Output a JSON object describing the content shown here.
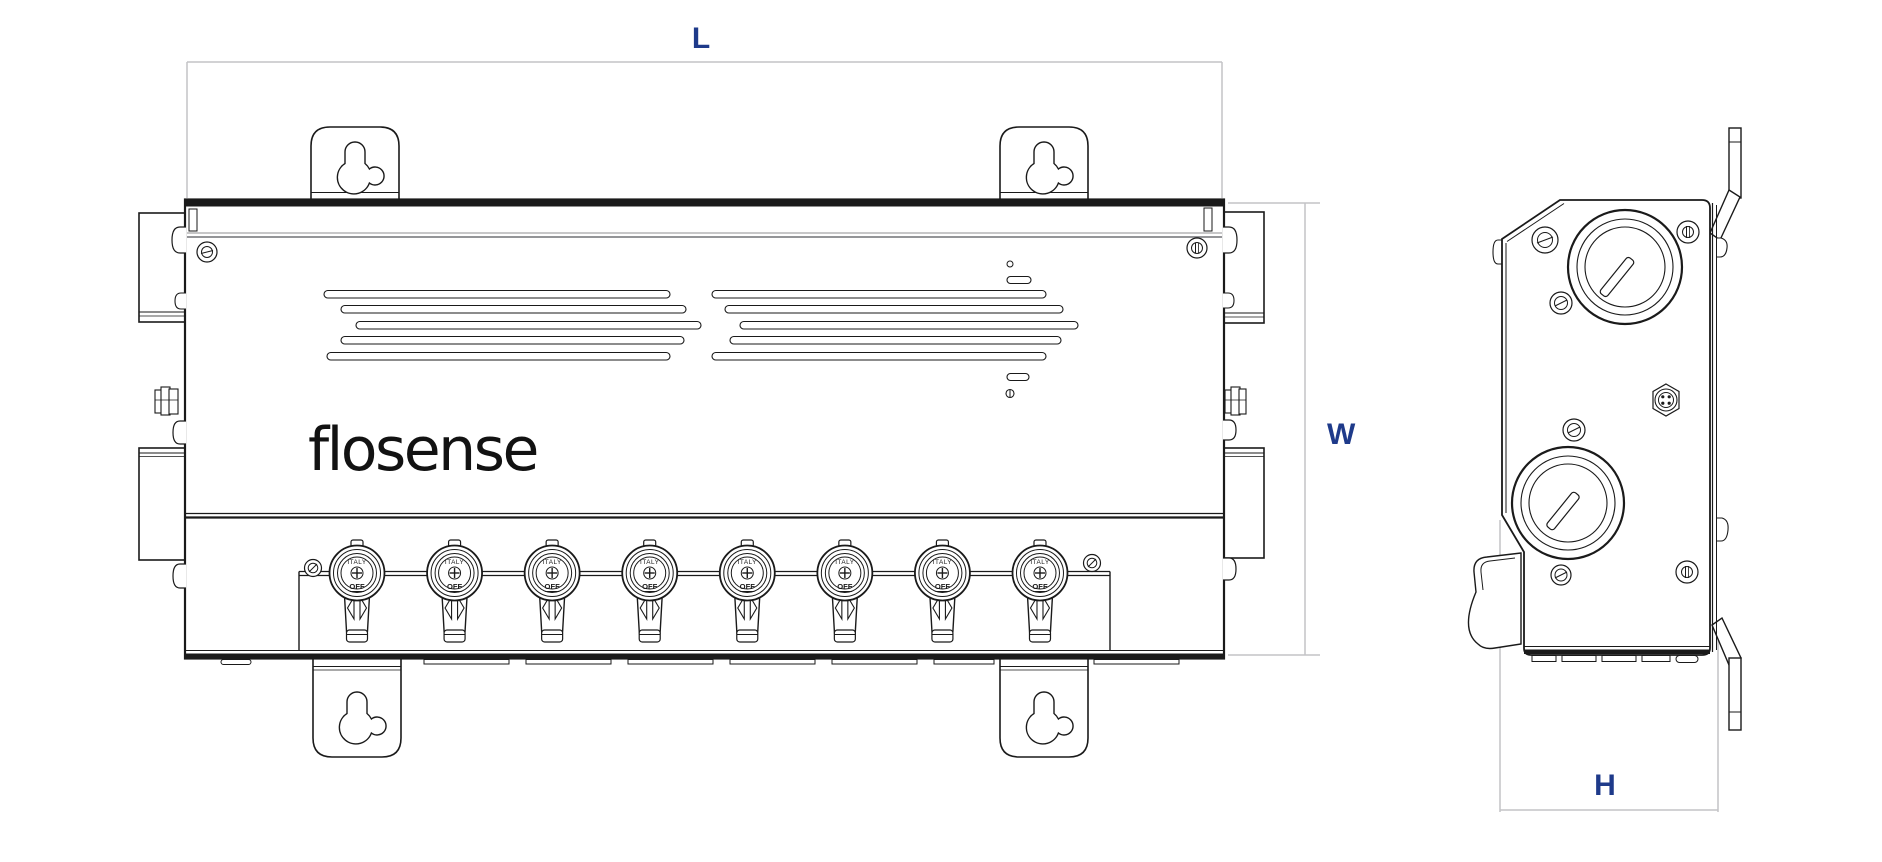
{
  "drawing": {
    "dimension_labels": {
      "length": "L",
      "width": "W",
      "height": "H"
    },
    "logo_text": "flosense",
    "valves": {
      "count": 8,
      "ring_label": "ITALY",
      "state_label": "OFF"
    },
    "colors": {
      "line": "#1a1a1a",
      "dimension_line": "#c3c3c6",
      "label": "#1e3a8a",
      "background": "#ffffff"
    }
  }
}
